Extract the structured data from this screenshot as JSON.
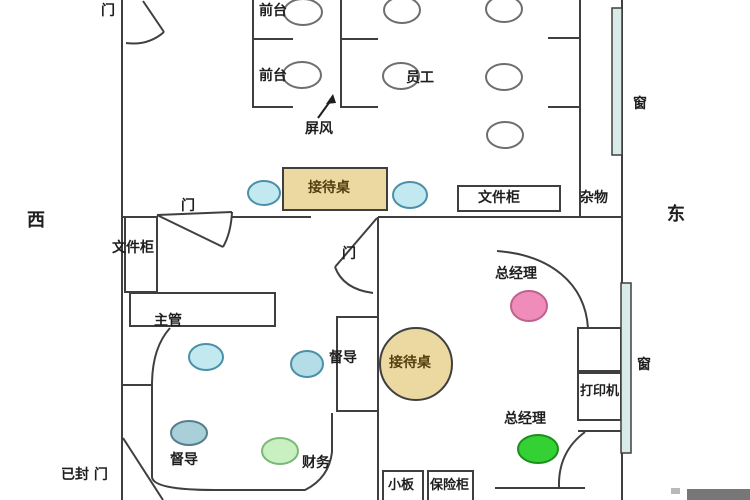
{
  "compass": {
    "west": "西",
    "east": "东"
  },
  "labels": {
    "door": "门",
    "sealed_door": "已封 门",
    "front_desk": "前台",
    "staff": "员工",
    "screen": "屏风",
    "reception_desk": "接待桌",
    "file_cabinet": "文件柜",
    "sundries": "杂物",
    "window": "窗",
    "general_manager": "总经理",
    "chief_supervisor": "主管",
    "supervisor": "督导",
    "finance": "财务",
    "printer": "打印机",
    "small_board": "小板",
    "safe": "保险柜"
  },
  "colors": {
    "wall": "#3f3f3f",
    "desk_tan": "#ecd9a2",
    "window_glass": "#d9ebe8",
    "seat_white": "#ffffff",
    "seat_cyan": "#c3e9f0",
    "seat_steel": "#a9cfd9",
    "seat_blue": "#b5dde8",
    "seat_pink": "#f08cba",
    "seat_green": "#33d133",
    "seat_green_light": "#c9f0c0",
    "watermark": "#777777"
  }
}
